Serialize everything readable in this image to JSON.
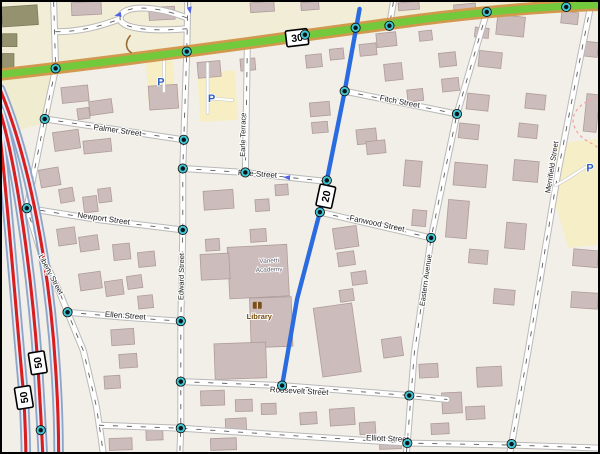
{
  "map": {
    "labels": {
      "palmer": "Palmer Street",
      "newport": "Newport Street",
      "pine": "Pine Street",
      "fitch": "Fitch Street",
      "fanwood": "Fanwood Street",
      "ellen": "Ellen Street",
      "roosevelt": "Roosevelt Street",
      "elliott": "Elliott Street",
      "liberty": "Liberty Street",
      "edward": "Edward Street",
      "earle": "Earle Terrace",
      "eastern": "Eastern Avenue",
      "merrifield": "Merrifield Street"
    },
    "shields": {
      "route30": "30",
      "route20": "20",
      "route50a": "50",
      "route50b": "50"
    },
    "pois": {
      "parking_symbol": "P",
      "library_label": "Library",
      "academy_line1": "Vanetti",
      "academy_line2": "Academy"
    },
    "colors": {
      "background": "#f2efe8",
      "land_strip": "#f1edd6",
      "parking_lot": "#f7efc3",
      "building": "#ccbcbb",
      "building_outline": "#af9c9a",
      "olive_building": "#95926f",
      "trunk_green": "#72c93b",
      "trunk_casing": "#d1984e",
      "primary_red": "#d81f1f",
      "primary_casing": "#8ea5c8",
      "route_highlight": "#2a6ce0",
      "node_ring": "#3cc8d4",
      "parking_blue": "#2f62c4",
      "boundary_pink": "#f2a6a6"
    },
    "geometry": {
      "route30": "M0,73 C150,56 300,34 420,18 C500,8 560,4 600,3",
      "blue_route": "M360,7 L345,90 L327,180 L320,212 L297,300 L282,387",
      "red_roads": [
        "M-2,88 C28,160 48,270 54,370 C56,400 57,430 57,456",
        "M-2,110 C16,170 30,280 36,364 C38,400 40,430 41,456",
        "M-2,135 C5,195 14,310 22,399 C23,420 24,440 24,456"
      ],
      "streets": [
        {
          "name": "top-left",
          "d": "M52,0 L54,67"
        },
        {
          "name": "liberty",
          "d": "M54,67 L43,118 L25,208 L40,255 L58,293 L66,313 L82,352 L95,408 L100,441 L102,456"
        },
        {
          "name": "palmer",
          "d": "M43,118 L183,139"
        },
        {
          "name": "edward",
          "d": "M187,0 L186,50 L183,139 L182,168 L182,230 L181,280 L180,322 L180,383 L180,430 L179,456"
        },
        {
          "name": "earle-terrace",
          "d": "M247,43 L245,172"
        },
        {
          "name": "pine",
          "d": "M182,168 L245,172 L280,176 L327,181"
        },
        {
          "name": "newport",
          "d": "M25,208 L100,220 L182,230"
        },
        {
          "name": "fitch",
          "d": "M345,90 L458,113"
        },
        {
          "name": "fanwood",
          "d": "M320,212 L432,238"
        },
        {
          "name": "eastern",
          "d": "M488,10 L458,113 L432,238 L415,355 L408,445 L407,456"
        },
        {
          "name": "merrifield",
          "d": "M593,2 L580,67 L560,170 L545,260 L530,350 L513,446 L511,456"
        },
        {
          "name": "ellen",
          "d": "M66,313 L122,318 L180,322"
        },
        {
          "name": "roosevelt",
          "d": "M180,383 L282,387 L410,397 L448,401"
        },
        {
          "name": "elliott",
          "d": "M98,427 L180,430 L300,438 L408,445 L513,447 L600,450"
        },
        {
          "name": "north-loop",
          "d": "M186,16 C150,2 122,4 119,15 C116,27 150,30 186,27"
        },
        {
          "name": "north-spur",
          "d": "M54,30 C80,30 100,24 119,17"
        },
        {
          "name": "north-c",
          "d": "M394,0 L390,24"
        },
        {
          "name": "north-d",
          "d": "M566,0 L568,5"
        }
      ],
      "service_paths": [
        "M163,52 L163,90",
        "M207,62 L207,112",
        "M207,97 L232,99",
        "M557,185 C568,180 578,172 590,165"
      ],
      "boundary": "M600,96 C584,100 571,112 576,125 C581,139 593,141 600,147",
      "track_arc": "M129,34 C124,40 124,47 130,51"
    },
    "buildings": [
      [
        70,
        0,
        30,
        13,
        -3
      ],
      [
        148,
        5,
        26,
        13,
        -3
      ],
      [
        250,
        0,
        24,
        10,
        -4
      ],
      [
        301,
        0,
        18,
        8,
        -4
      ],
      [
        399,
        0,
        21,
        8,
        -5
      ],
      [
        455,
        2,
        22,
        11,
        -5
      ],
      [
        542,
        0,
        22,
        9,
        -5
      ],
      [
        60,
        85,
        27,
        16,
        -6
      ],
      [
        88,
        99,
        23,
        14,
        -8
      ],
      [
        148,
        84,
        29,
        24,
        -4
      ],
      [
        76,
        107,
        12,
        11,
        -8
      ],
      [
        52,
        130,
        26,
        19,
        -8
      ],
      [
        82,
        139,
        28,
        13,
        -6
      ],
      [
        38,
        168,
        20,
        18,
        -10
      ],
      [
        58,
        188,
        14,
        14,
        -10
      ],
      [
        82,
        196,
        14,
        16,
        -7
      ],
      [
        97,
        188,
        13,
        14,
        -7
      ],
      [
        56,
        228,
        18,
        17,
        -8
      ],
      [
        78,
        236,
        19,
        15,
        -8
      ],
      [
        112,
        244,
        17,
        16,
        -6
      ],
      [
        137,
        252,
        17,
        15,
        -6
      ],
      [
        78,
        273,
        22,
        17,
        -8
      ],
      [
        104,
        281,
        18,
        15,
        -8
      ],
      [
        126,
        276,
        15,
        13,
        -8
      ],
      [
        137,
        296,
        15,
        13,
        -6
      ],
      [
        110,
        330,
        23,
        16,
        -4
      ],
      [
        118,
        355,
        18,
        14,
        -4
      ],
      [
        103,
        377,
        16,
        13,
        -4
      ],
      [
        108,
        440,
        23,
        12,
        -2
      ],
      [
        145,
        431,
        17,
        11,
        -2
      ],
      [
        210,
        440,
        26,
        12,
        -2
      ],
      [
        197,
        60,
        23,
        16,
        -5
      ],
      [
        240,
        57,
        15,
        12,
        -5
      ],
      [
        306,
        53,
        16,
        13,
        -6
      ],
      [
        330,
        47,
        14,
        11,
        -6
      ],
      [
        360,
        42,
        17,
        12,
        -6
      ],
      [
        377,
        31,
        20,
        14,
        -6
      ],
      [
        385,
        62,
        18,
        17,
        -6
      ],
      [
        408,
        88,
        16,
        12,
        -6
      ],
      [
        420,
        29,
        13,
        10,
        -6
      ],
      [
        440,
        51,
        17,
        14,
        -6
      ],
      [
        443,
        77,
        17,
        13,
        -6
      ],
      [
        310,
        101,
        20,
        14,
        -5
      ],
      [
        312,
        121,
        16,
        11,
        -5
      ],
      [
        357,
        128,
        20,
        15,
        -6
      ],
      [
        367,
        140,
        19,
        13,
        -6
      ],
      [
        203,
        190,
        30,
        19,
        -4
      ],
      [
        255,
        199,
        14,
        12,
        -4
      ],
      [
        275,
        184,
        13,
        11,
        -4
      ],
      [
        250,
        229,
        16,
        13,
        -4
      ],
      [
        205,
        239,
        14,
        12,
        -4
      ],
      [
        334,
        227,
        24,
        21,
        -8
      ],
      [
        338,
        252,
        17,
        14,
        -8
      ],
      [
        352,
        272,
        15,
        13,
        -8
      ],
      [
        340,
        290,
        14,
        12,
        -8
      ],
      [
        383,
        339,
        20,
        19,
        -8
      ],
      [
        318,
        306,
        39,
        70,
        -8
      ],
      [
        200,
        392,
        24,
        15,
        -2
      ],
      [
        235,
        401,
        17,
        12,
        -2
      ],
      [
        261,
        405,
        15,
        11,
        -2
      ],
      [
        225,
        420,
        21,
        13,
        -3
      ],
      [
        300,
        414,
        17,
        12,
        -4
      ],
      [
        330,
        410,
        25,
        17,
        -4
      ],
      [
        360,
        424,
        16,
        12,
        -4
      ],
      [
        380,
        440,
        22,
        11,
        -2
      ],
      [
        228,
        246,
        60,
        52,
        -3
      ],
      [
        200,
        254,
        29,
        26,
        -3
      ],
      [
        250,
        298,
        42,
        50,
        -2
      ],
      [
        214,
        344,
        52,
        36,
        -2
      ],
      [
        405,
        160,
        17,
        26,
        5
      ],
      [
        413,
        210,
        14,
        16,
        5
      ],
      [
        498,
        14,
        28,
        20,
        6
      ],
      [
        563,
        10,
        17,
        12,
        6
      ],
      [
        480,
        50,
        23,
        16,
        6
      ],
      [
        468,
        93,
        22,
        16,
        6
      ],
      [
        460,
        123,
        20,
        15,
        6
      ],
      [
        527,
        93,
        20,
        15,
        6
      ],
      [
        520,
        123,
        19,
        14,
        6
      ],
      [
        455,
        163,
        33,
        23,
        5
      ],
      [
        515,
        160,
        25,
        21,
        5
      ],
      [
        448,
        200,
        21,
        38,
        5
      ],
      [
        507,
        223,
        20,
        26,
        5
      ],
      [
        470,
        250,
        19,
        14,
        5
      ],
      [
        495,
        290,
        21,
        15,
        5
      ],
      [
        476,
        26,
        14,
        10,
        6
      ],
      [
        582,
        40,
        18,
        15,
        6
      ],
      [
        587,
        93,
        13,
        38,
        6
      ],
      [
        575,
        250,
        25,
        17,
        5
      ],
      [
        573,
        293,
        27,
        16,
        4
      ],
      [
        420,
        365,
        19,
        14,
        -3
      ],
      [
        443,
        394,
        20,
        21,
        -3
      ],
      [
        478,
        368,
        25,
        20,
        -3
      ],
      [
        467,
        408,
        19,
        13,
        -3
      ],
      [
        432,
        425,
        18,
        11,
        -3
      ]
    ],
    "olive_buildings": [
      [
        0,
        4,
        36,
        20,
        -4
      ],
      [
        0,
        32,
        15,
        13,
        0
      ],
      [
        0,
        52,
        12,
        15,
        0
      ]
    ],
    "nodes": [
      [
        54,
        67
      ],
      [
        186,
        50
      ],
      [
        305,
        33
      ],
      [
        356,
        26
      ],
      [
        390,
        24
      ],
      [
        488,
        10
      ],
      [
        568,
        5
      ],
      [
        345,
        90
      ],
      [
        327,
        180
      ],
      [
        320,
        212
      ],
      [
        282,
        387
      ],
      [
        183,
        139
      ],
      [
        182,
        168
      ],
      [
        182,
        230
      ],
      [
        180,
        322
      ],
      [
        180,
        383
      ],
      [
        180,
        430
      ],
      [
        43,
        118
      ],
      [
        25,
        208
      ],
      [
        66,
        313
      ],
      [
        245,
        172
      ],
      [
        458,
        113
      ],
      [
        432,
        238
      ],
      [
        410,
        397
      ],
      [
        408,
        445
      ],
      [
        513,
        446
      ],
      [
        39,
        432
      ]
    ],
    "oneway_arrows": [
      [
        117,
        13,
        170
      ],
      [
        189,
        8,
        80
      ],
      [
        287,
        177,
        185
      ]
    ],
    "parking_positions": [
      [
        160,
        80
      ],
      [
        211,
        97
      ],
      [
        592,
        167
      ]
    ]
  }
}
